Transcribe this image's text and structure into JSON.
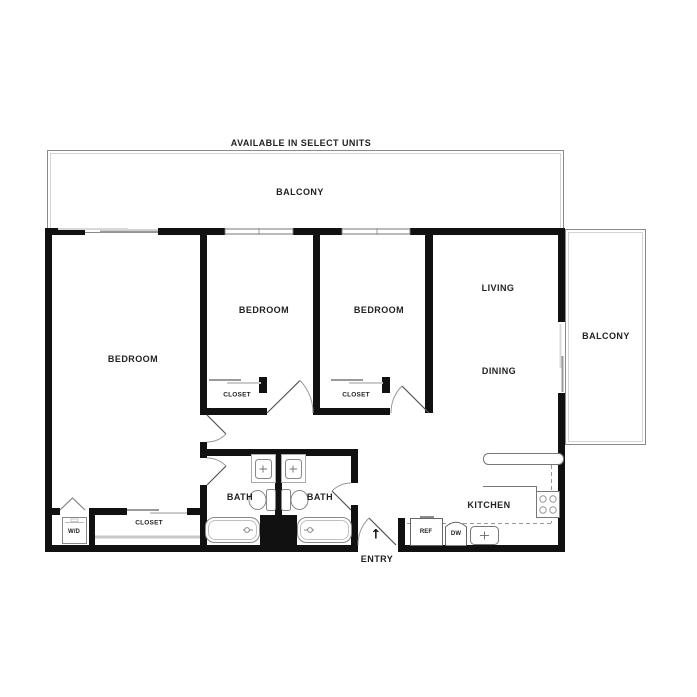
{
  "banner": "AVAILABLE IN SELECT UNITS",
  "rooms": {
    "balcony_top": "BALCONY",
    "balcony_right": "BALCONY",
    "bedroom_master": "BEDROOM",
    "bedroom_2": "BEDROOM",
    "bedroom_3": "BEDROOM",
    "living": "LIVING",
    "dining": "DINING",
    "kitchen": "KITCHEN",
    "bath_1": "BATH",
    "bath_2": "BATH",
    "entry": "ENTRY"
  },
  "storage": {
    "closet_bedroom_2": "CLOSET",
    "closet_bedroom_3": "CLOSET",
    "closet_hall": "CLOSET",
    "laundry": "W/D"
  },
  "appliances": {
    "refrigerator": "REF",
    "dishwasher": "DW"
  },
  "icons": {
    "entry_arrow": "↑"
  },
  "colors": {
    "wall": "#111111",
    "text": "#222222",
    "fixture_line": "#888888",
    "light_line": "#c8c8c8",
    "background": "#ffffff"
  }
}
